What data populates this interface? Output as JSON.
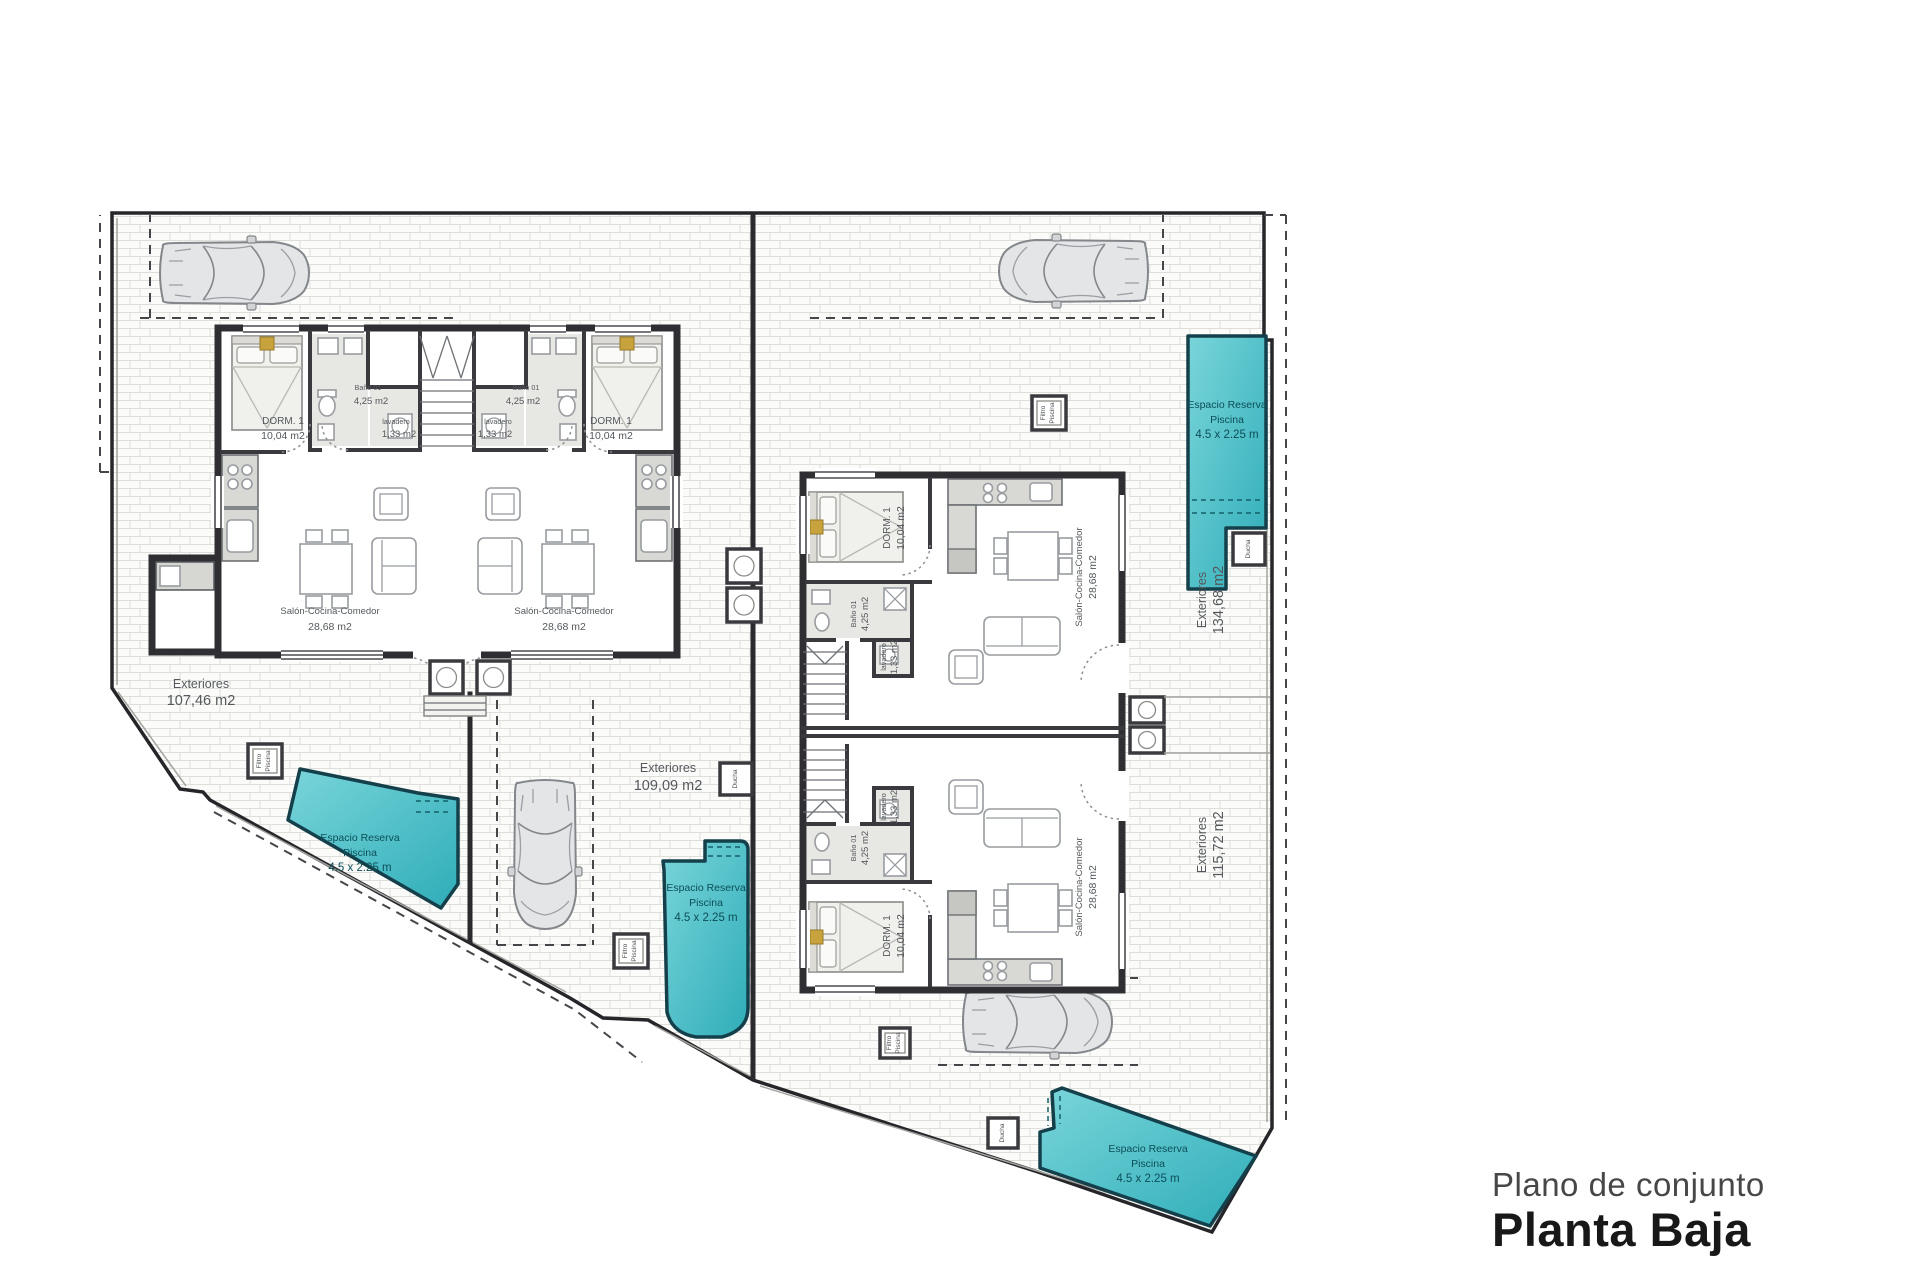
{
  "title": {
    "subtitle": "Plano de conjunto",
    "main": "Planta Baja"
  },
  "rooms": {
    "bedroom": {
      "name": "DORM. 1",
      "area": "10,04 m2"
    },
    "bathroom": {
      "name": "Baño 01",
      "area": "4,25 m2"
    },
    "laundry": {
      "name": "lavadero",
      "area": "1,33 m2"
    },
    "living": {
      "name": "Salón-Cocina-Comedor",
      "area": "28,68 m2"
    }
  },
  "exteriors": {
    "label": "Exteriores",
    "unit1_area": "107,46 m2",
    "unit2_area": "109,09 m2",
    "unit3_area": "134,68 m2",
    "unit4_area": "115,72 m2"
  },
  "pool": {
    "line1": "Espacio Reserva",
    "line2": "Piscina",
    "line3": "4.5 x 2.25 m"
  },
  "equipment": {
    "filter_line1": "Filtro",
    "filter_line2": "Piscina",
    "shower": "Ducha"
  },
  "colors": {
    "pool_fill": "#41c0c9",
    "pool_stroke": "#14404b",
    "wall": "#2f2f33",
    "paving_joint": "#dededa",
    "accent_tan": "#c7a23d"
  }
}
